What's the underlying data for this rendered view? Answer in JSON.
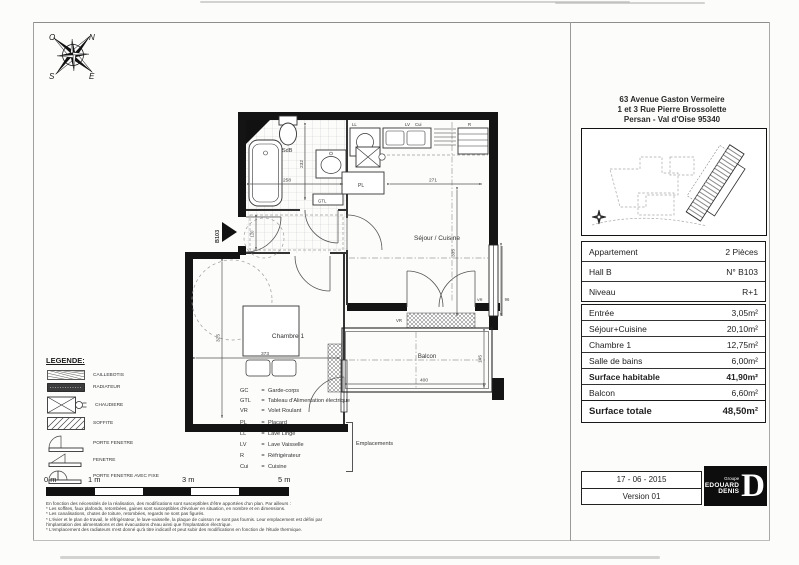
{
  "header": {
    "address_line1": "63 Avenue Gaston Vermeire",
    "address_line2": "1 et 3 Rue Pierre Brossolette",
    "address_line3": "Persan - Val d'Oise 95340"
  },
  "info_table": {
    "rows": [
      {
        "label": "Appartement",
        "value": "2 Pièces"
      },
      {
        "label": "Hall B",
        "value": "N° B103"
      },
      {
        "label": "Niveau",
        "value": "R+1"
      }
    ]
  },
  "surface_table": {
    "rows": [
      {
        "label": "Entrée",
        "value": "3,05m²"
      },
      {
        "label": "Séjour+Cuisine",
        "value": "20,10m²"
      },
      {
        "label": "Chambre 1",
        "value": "12,75m²"
      },
      {
        "label": "Salle de bains",
        "value": "6,00m²"
      },
      {
        "label": "Surface habitable",
        "value": "41,90m²"
      },
      {
        "label": "Balcon",
        "value": "6,60m²"
      }
    ]
  },
  "total_table": {
    "label": "Surface totale",
    "value": "48,50m²"
  },
  "stamp": {
    "date": "17 - 06 - 2015",
    "version": "Version 01"
  },
  "logo": {
    "groupe": "Groupe",
    "name1": "EDOUARD",
    "name2": "DENIS",
    "letter": "D"
  },
  "compass": {
    "n": "N",
    "o": "O",
    "e": "E",
    "s": "S"
  },
  "plan": {
    "labels": {
      "sdb": "SdB",
      "sejour": "Séjour / Cuisine",
      "chambre": "Chambre 1",
      "balcon": "Balcon",
      "ll": "LL",
      "lv": "LV",
      "cui": "Cui",
      "r": "R",
      "pl": "PL",
      "gtl": "GTL",
      "vr": "VR",
      "b103": "B103"
    },
    "dims": {
      "d258": "258",
      "d232": "232",
      "d271": "271",
      "d335": "335",
      "d373": "373",
      "d325": "325",
      "d400": "400",
      "d145": "145",
      "d96": "96",
      "d120": "120"
    }
  },
  "legend": {
    "title": "LEGENDE:",
    "eq": "=",
    "symbols": [
      {
        "icon": "caillebotis",
        "label": "CAILLEBOTIS"
      },
      {
        "icon": "radiateur",
        "label": "RADIATEUR"
      },
      {
        "icon": "chaudiere",
        "label": "CHAUDIERE"
      },
      {
        "icon": "soffite",
        "label": "SOFFITE"
      },
      {
        "icon": "porte-fenetre",
        "label": "PORTE FENETRE"
      },
      {
        "icon": "fenetre",
        "label": "FENETRE"
      },
      {
        "icon": "porte-fenetre-fixe",
        "label": "PORTE FENETRE AVEC FIXE"
      }
    ],
    "abbreviations": [
      {
        "abbr": "GC",
        "label": "Garde-corps"
      },
      {
        "abbr": "GTL",
        "label": "Tableau d'Alimentation électrique"
      },
      {
        "abbr": "VR",
        "label": "Volet Roulant"
      },
      {
        "abbr": "PL",
        "label": "Placard"
      },
      {
        "abbr": "LL",
        "label": "Lave Linge"
      },
      {
        "abbr": "LV",
        "label": "Lave Vaisselle"
      },
      {
        "abbr": "R",
        "label": "Réfrigérateur"
      },
      {
        "abbr": "Cui",
        "label": "Cuisine"
      }
    ],
    "group_label": "Emplacements"
  },
  "scalebar": {
    "labels": [
      "0 m",
      "1 m",
      "3 m",
      "5 m"
    ]
  },
  "footnotes": [
    "En fonction des nécessités de la réalisation, des modifications sont susceptibles d'être apportées d'un plan. Par ailleurs :",
    "* Les soffites, faux plafonds, retombées, gaines sont susceptibles d'évoluer en situation, en nombre et en dimensions.",
    "* Les canalisations, chutes de toiture, retombées, regards ne sont pas figurés.",
    "* L'évier et le plan de travail, le réfrigérateur, le lave-vaisselle, la plaque de cuisson ne sont pas fournis. Leur emplacement est défini par",
    "  l'implantation des alimentations et des évacuations d'eau ainsi que l'implantation électrique.",
    "* L'emplacement des radiateurs n'est donné qu'à titre indicatif et peut subir des modifications en fonction de l'étude thermique."
  ]
}
